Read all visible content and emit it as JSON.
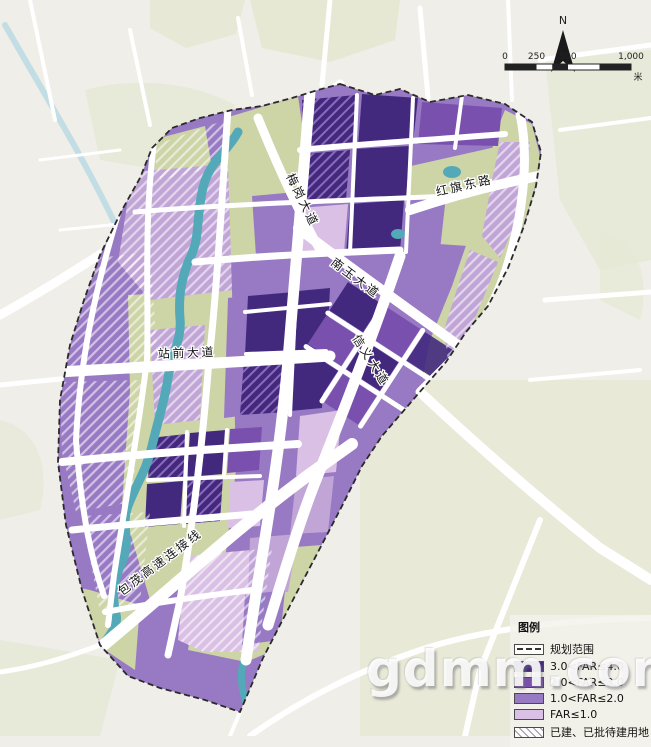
{
  "map": {
    "compass_label": "N",
    "scale_bar": {
      "ticks": [
        "0",
        "250",
        "500",
        "1,000"
      ],
      "unit": "米"
    },
    "road_labels": {
      "hongqi_east": "红旗东路",
      "meigang": "梅岗大道",
      "nanyu": "南玉大道",
      "xinyi": "信义大道",
      "zhanqian": "站前大道",
      "baomao_connector": "包茂高速连接线"
    }
  },
  "legend": {
    "title": "图例",
    "items": [
      {
        "label": "规划范围"
      },
      {
        "label": "3.0<FAR≤4.0"
      },
      {
        "label": "2.0<FAR≤3.0"
      },
      {
        "label": "1.0<FAR≤2.0"
      },
      {
        "label": "FAR≤1.0"
      },
      {
        "label": "已建、已批待建用地"
      }
    ]
  },
  "watermark": "gdmm.com",
  "colors": {
    "far_3_4": "#43297e",
    "far_2_3": "#7a50ae",
    "far_1_2": "#9879c4",
    "far_le_1": "#d9c0e4",
    "purple_soft": "#c0a5d6",
    "greenland": "#cdd4a6",
    "green_outside": "#e6e8d4",
    "water": "#54a9b8",
    "water_outside": "#c2dde4",
    "road": "#ffffff",
    "bg_outside": "#efeee8",
    "boundary": "#2a2a2a"
  }
}
